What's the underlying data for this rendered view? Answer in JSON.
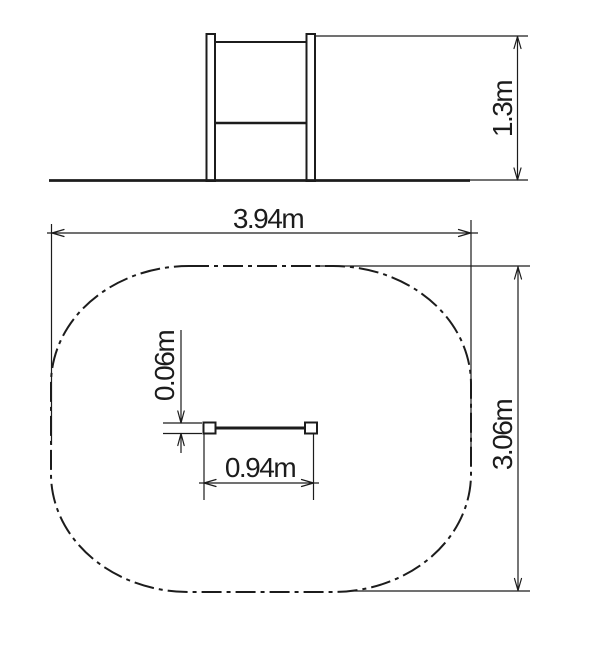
{
  "drawing": {
    "type": "technical-dimension-drawing",
    "subject": "playground horizontal bar with safety zone",
    "background_color": "#ffffff",
    "line_color": "#1c1c1c",
    "front_view": {
      "height_dimension": "1.3m"
    },
    "plan_view": {
      "overall_width_dimension": "3.94m",
      "overall_depth_dimension": "3.06m",
      "bar_length_dimension": "0.94m",
      "bar_post_width_dimension": "0.06m"
    }
  }
}
